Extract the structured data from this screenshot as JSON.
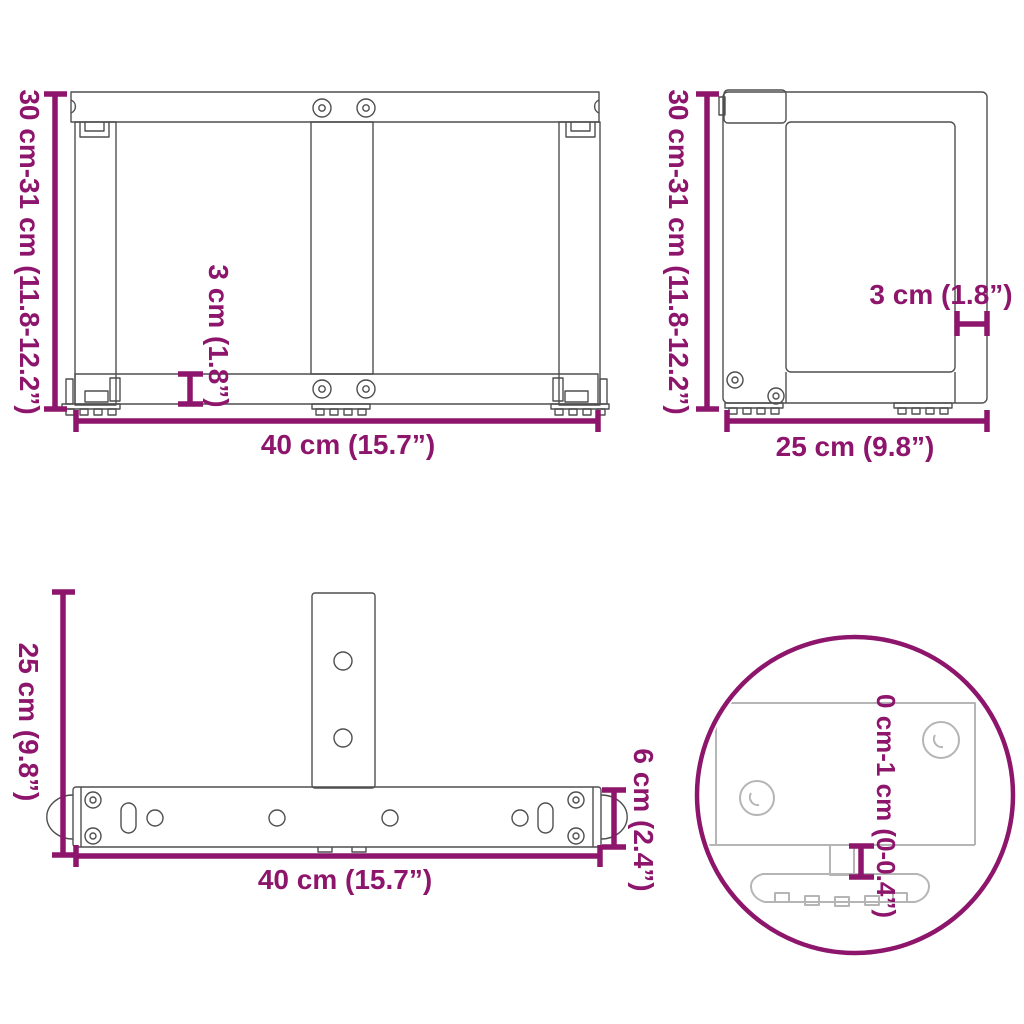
{
  "colors": {
    "accent": "#8D156B",
    "line": "#4F4F4F",
    "detail": "#B5B5B5",
    "background": "#FFFFFF"
  },
  "diagram": {
    "front_view": {
      "height_label": "30 cm-31 cm (11.8-12.2”)",
      "width_label": "40 cm (15.7”)",
      "bar_thickness_label": "3 cm (1.8”)"
    },
    "side_view": {
      "height_label": "30 cm-31 cm (11.8-12.2”)",
      "depth_label": "25 cm (9.8”)",
      "bar_thickness_label": "3 cm (1.8”)"
    },
    "top_view": {
      "depth_label": "25 cm (9.8”)",
      "width_label": "40 cm (15.7”)",
      "bar_width_label": "6 cm (2.4”)"
    },
    "foot_detail": {
      "adjustable_range_label": "0 cm-1 cm (0-0.4”)"
    }
  }
}
